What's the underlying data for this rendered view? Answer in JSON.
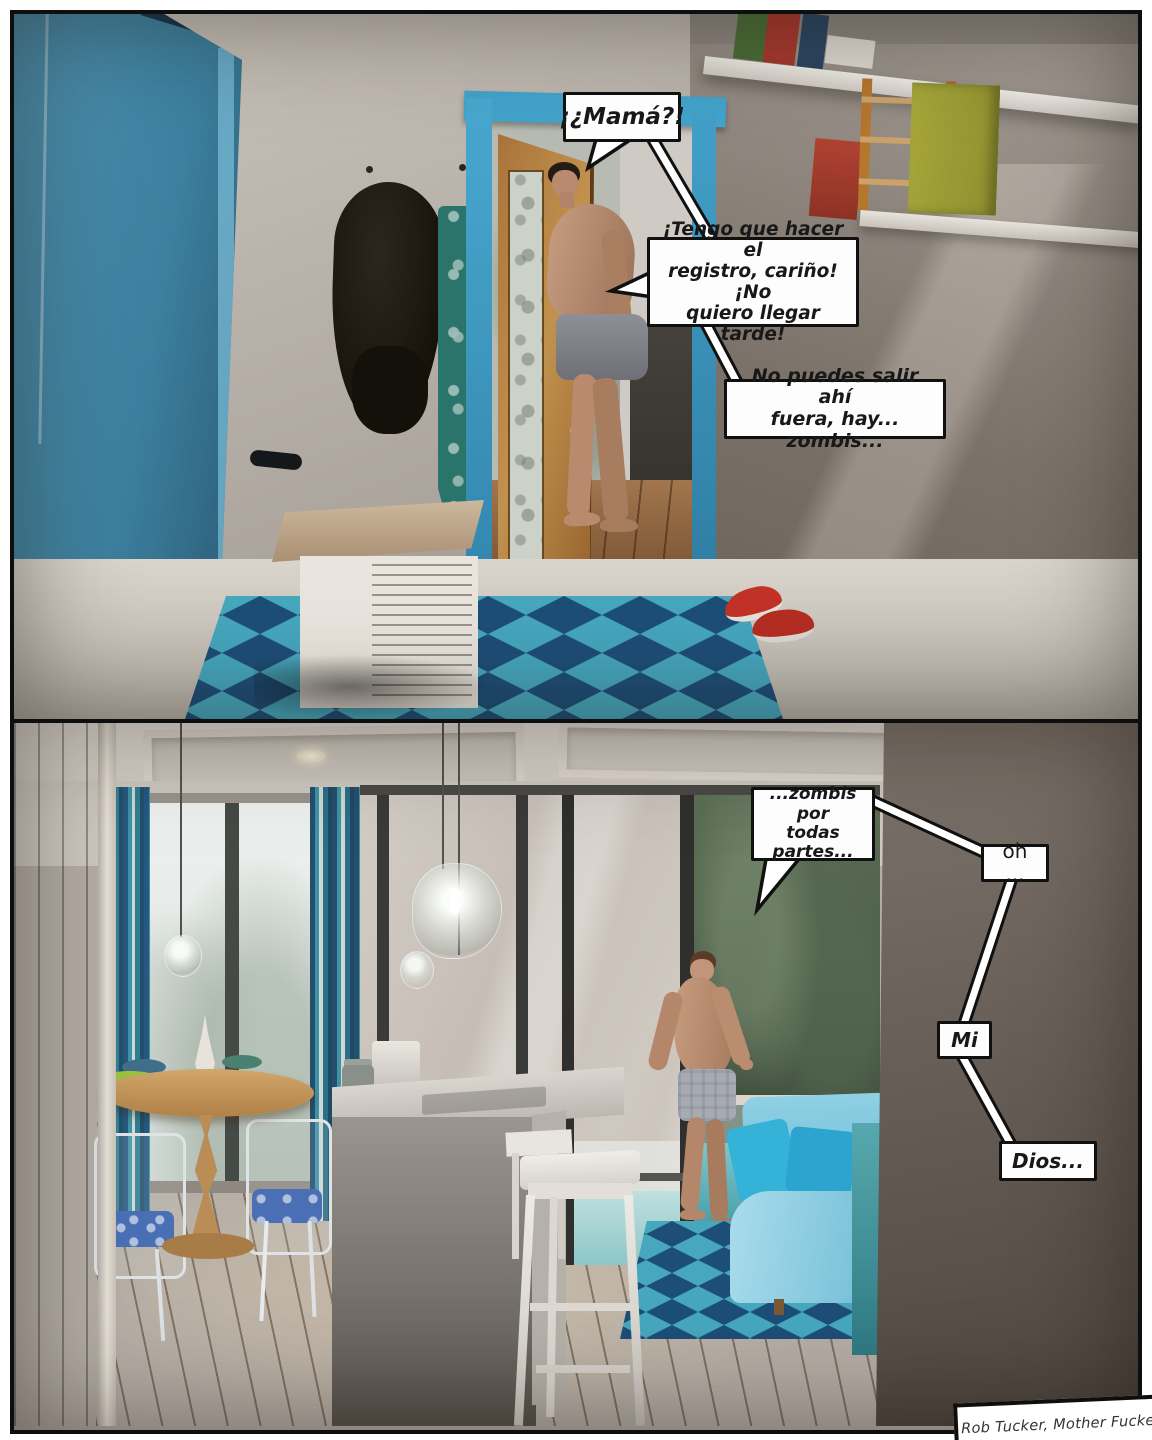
{
  "page_type": "comic-page",
  "panel1": {
    "bubbles": [
      {
        "id": "mama",
        "text": "¡¿Mamá?!"
      },
      {
        "id": "registro",
        "text": "¡Tengo que hacer el\nregistro, cariño! ¡No\nquiero llegar tarde!"
      },
      {
        "id": "zombis",
        "text": "No puedes salir ahí\nfuera, hay... zombis..."
      }
    ]
  },
  "panel2": {
    "bubbles": [
      {
        "id": "todas-partes",
        "text": "...zombis por\ntodas\npartes..."
      },
      {
        "id": "oh",
        "text": "oh ..."
      },
      {
        "id": "mi",
        "text": "Mi"
      },
      {
        "id": "dios",
        "text": "Dios..."
      }
    ]
  },
  "caption": {
    "credit": "Rob Tucker, Mother Fucker"
  },
  "colors": {
    "panel_border": "#0e0e0e",
    "bubble_bg": "#fdfdfd",
    "bubble_border": "#101010",
    "blue_door": "#3f82a3",
    "door_frame_blue": "#47a6cd",
    "rug_navy": "#1d4e78",
    "rug_teal": "#2a9cb8",
    "sofa_blue": "#9fd2e4",
    "pillow_cyan": "#2fb0d8",
    "sneaker_red": "#c23227",
    "wood_floor": "#9a6433",
    "towel_teal": "#2b746b",
    "foreground_wall": "#6a615a"
  }
}
